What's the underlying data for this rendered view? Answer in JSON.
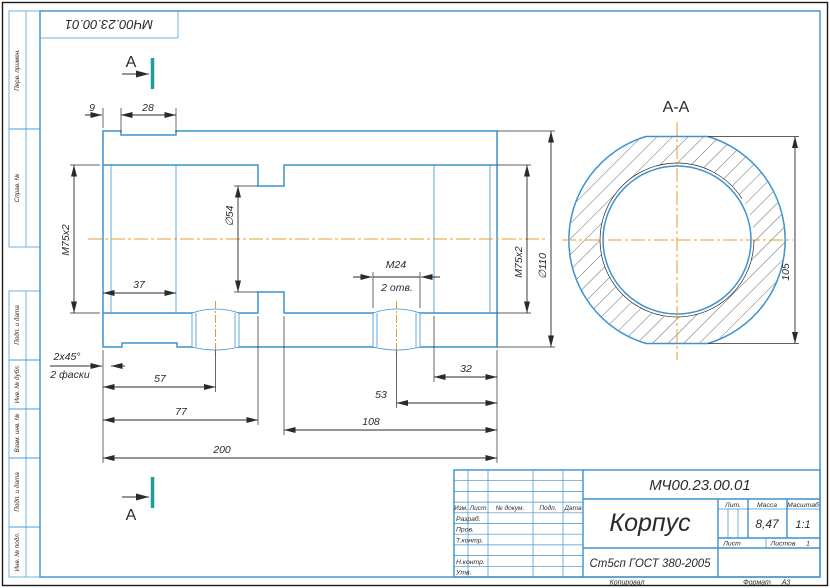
{
  "drawing": {
    "stamp_top": "МЧ00.23.00.01",
    "section_letter": "А",
    "section_title": "А-А"
  },
  "colors": {
    "outline_blue": "#3d92cf",
    "line_dark": "#2a2a2a",
    "centerline_orange": "#e89b30",
    "section_marker_teal": "#1f9e96"
  },
  "frame_labels": [
    "Перв. примен.",
    "Справ. №",
    "Подп. и дата",
    "Инв. № дубл.",
    "Взам. инв. №",
    "Подп. и дата",
    "Инв. № подл."
  ],
  "dims": {
    "len9": "9",
    "len28": "28",
    "thread_left": "М75х2",
    "bore54": "∅54",
    "len37": "37",
    "m24": "М24",
    "holes_note": "2 отв.",
    "thread_right": "М75х2",
    "outer110": "∅110",
    "len32": "32",
    "len53": "53",
    "len57": "57",
    "len77": "77",
    "len108": "108",
    "len200": "200",
    "chamfer": "2х45°",
    "chamfer_note": "2 фаски",
    "flats105": "105"
  },
  "title_block": {
    "doc_number": "МЧ00.23.00.01",
    "part_name": "Корпус",
    "material": "Ст5сп ГОСТ 380-2005",
    "lit_label": "Лит.",
    "mass_label": "Масса",
    "scale_label": "Масштаб",
    "mass_value": "8,47",
    "scale_value": "1:1",
    "sheet_label": "Лист",
    "sheets_label": "Листов",
    "sheets_value": "1",
    "header_cols": [
      "Изм.",
      "Лист",
      "№ докум.",
      "Подп.",
      "Дата"
    ],
    "sig_rows": [
      "Разраб.",
      "Пров.",
      "Т.контр.",
      "Н.контр.",
      "Утв."
    ],
    "copied_label": "Копировал",
    "format_label": "Формат",
    "format_value": "А3"
  }
}
